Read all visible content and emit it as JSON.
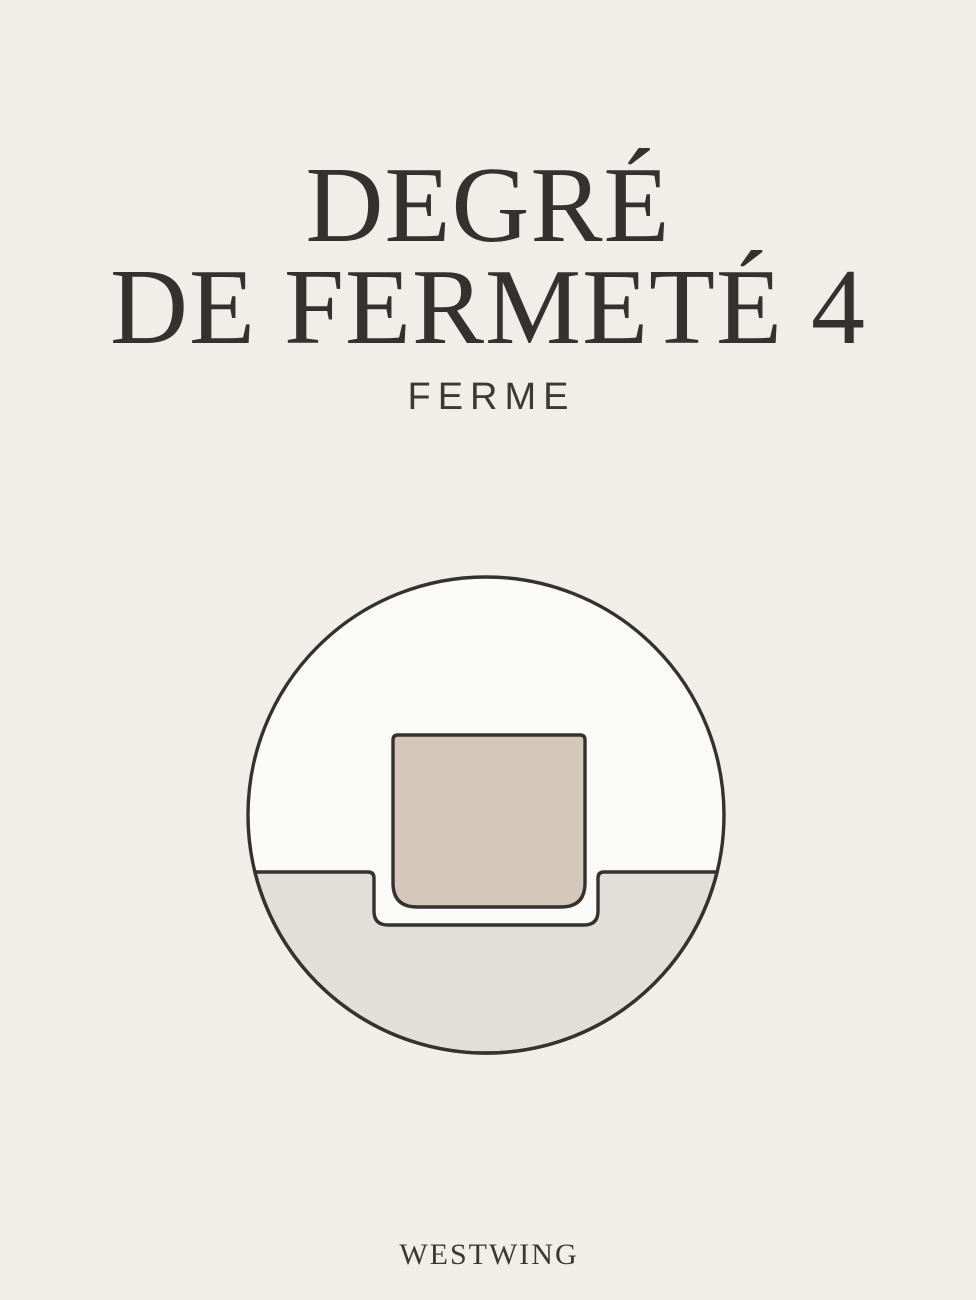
{
  "page": {
    "background_color": "#f1eeea",
    "text_color": "#343230"
  },
  "header": {
    "title_line1": "DEGRÉ",
    "title_line2": "DE FERMETÉ 4",
    "subtitle": "FERME",
    "firmness_level": "4",
    "firmness_label": "FERME"
  },
  "illustration": {
    "name": "firmness-level-diagram",
    "icon": "weight-block-pressing-firm-mattress-icon",
    "colors": {
      "outline": "#34322e",
      "upper_fill": "#fafaf9",
      "lower_fill": "#e2dfd9",
      "block_fill": "#d5c7ba"
    }
  },
  "footer": {
    "brand": "WESTWING"
  }
}
